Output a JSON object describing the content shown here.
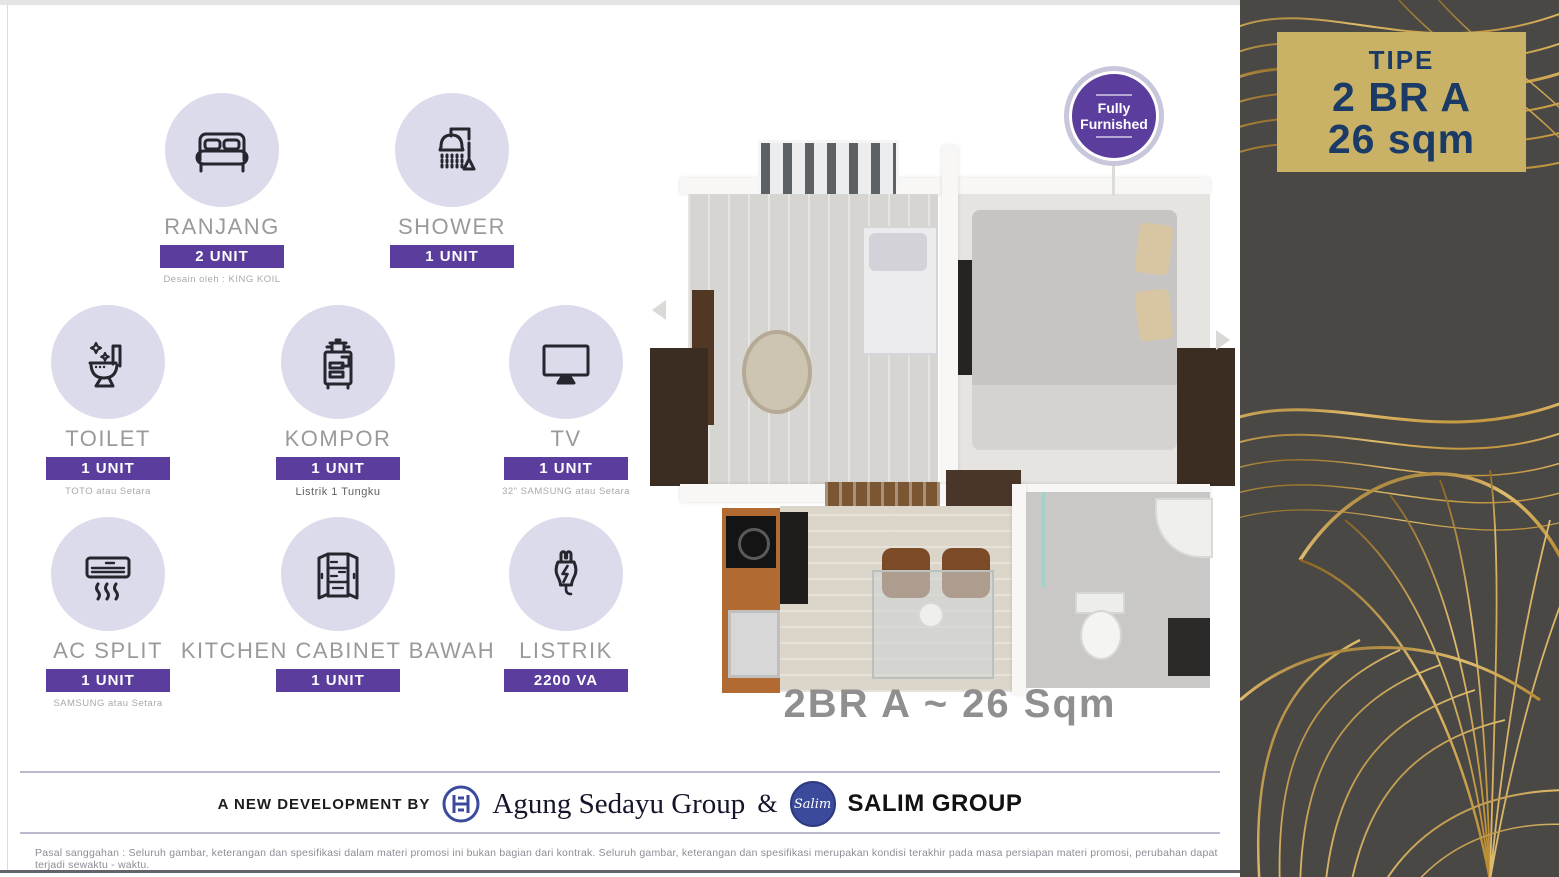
{
  "type_box": {
    "line1": "TIPE",
    "line2": "2 BR A",
    "line3": "26 sqm"
  },
  "furnish_badge": {
    "line1": "Fully",
    "line2": "Furnished"
  },
  "plan": {
    "caption": "2BR A ~ 26 Sqm"
  },
  "items": [
    {
      "icon": "bed-icon",
      "name": "RANJANG",
      "qty": "2 UNIT",
      "note": "Desain oleh : KING KOIL"
    },
    {
      "icon": "shower-icon",
      "name": "SHOWER",
      "qty": "1 UNIT",
      "note": ""
    },
    {
      "icon": "toilet-icon",
      "name": "TOILET",
      "qty": "1 UNIT",
      "note": "TOTO atau Setara"
    },
    {
      "icon": "stove-icon",
      "name": "KOMPOR",
      "qty": "1 UNIT",
      "note": "Listrik 1 Tungku"
    },
    {
      "icon": "tv-icon",
      "name": "TV",
      "qty": "1 UNIT",
      "note": "32\" SAMSUNG atau Setara"
    },
    {
      "icon": "ac-icon",
      "name": "AC SPLIT",
      "qty": "1 UNIT",
      "note": "SAMSUNG atau Setara"
    },
    {
      "icon": "cabinet-icon",
      "name": "KITCHEN CABINET BAWAH",
      "qty": "1 UNIT",
      "note": ""
    },
    {
      "icon": "plug-icon",
      "name": "LISTRIK",
      "qty": "2200 VA",
      "note": ""
    }
  ],
  "footer": {
    "prefix": "A NEW DEVELOPMENT BY",
    "developer1": "Agung Sedayu Group",
    "amp": "&",
    "salim_script": "Salim",
    "developer2": "SALIM GROUP",
    "disclaimer": "Pasal sanggahan : Seluruh gambar, keterangan dan spesifikasi dalam materi promosi ini bukan bagian dari kontrak. Seluruh gambar, keterangan dan spesifikasi merupakan kondisi terakhir pada masa persiapan materi promosi, perubahan dapat terjadi sewaktu - waktu."
  },
  "colors": {
    "accent_purple": "#5b3d9e",
    "icon_circle_bg": "#dcdbec",
    "gold_box": "#c9b266",
    "navy_text": "#1b3a66",
    "panel_bg": "#494845",
    "gold_line": "#c9a14e"
  }
}
